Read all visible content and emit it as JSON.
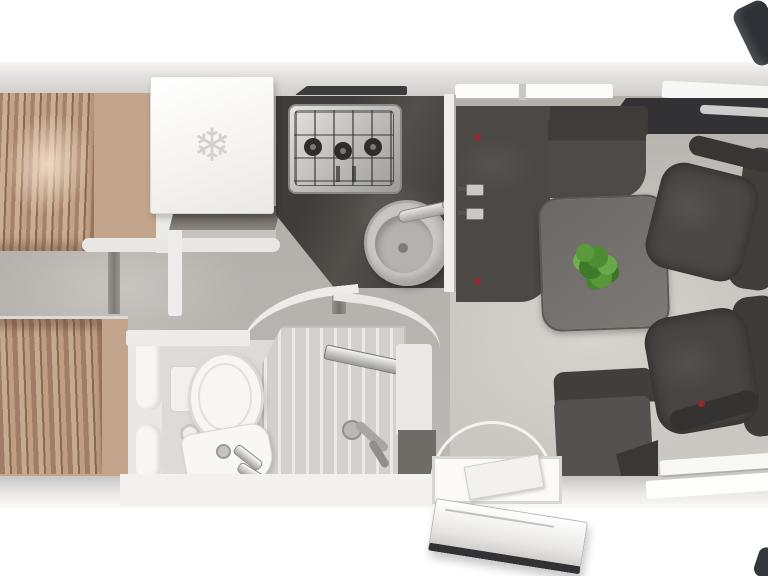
{
  "scene": {
    "type": "motorhome-interior-floor-plan",
    "view": "top-down-3d-render"
  },
  "glyphs": {
    "snowflake": "❄"
  },
  "palette": {
    "body": "#d8d7d5",
    "floor_bedroom": "#b4b1ad",
    "floor_lounge": "#c8c4bf",
    "counter": "#474441",
    "upholstery": "#4c4846",
    "chair": "#4a4744",
    "table": "#6f6c69",
    "bed": "#c2a58c",
    "bed_fold_shadow": "#9e7f66",
    "fixture_white": "#f4f3f1",
    "plant": "#57963c",
    "accent_red": "#8e2d2b",
    "mirror": "#2e3136",
    "window_trim_dark": "#323234"
  },
  "rooms": {
    "bedroom": [
      "twin-bed-top",
      "twin-bed-bottom",
      "center-aisle-steps"
    ],
    "kitchen": [
      "refrigerator",
      "three-burner-gas-hob",
      "round-sink-with-faucet",
      "dark-worktop"
    ],
    "bathroom": [
      "toilet",
      "washbasin",
      "shower-tray",
      "shower-tap"
    ],
    "lounge": [
      "l-shaped-sofa",
      "dinette-table",
      "green-plant",
      "travel-bench-seat"
    ],
    "cab": [
      "swivel-chair-top",
      "swivel-chair-bottom",
      "wing-mirror-top",
      "wing-mirror-bottom"
    ],
    "entry": [
      "entry-step",
      "open-entry-door",
      "door-swing-arc"
    ]
  }
}
